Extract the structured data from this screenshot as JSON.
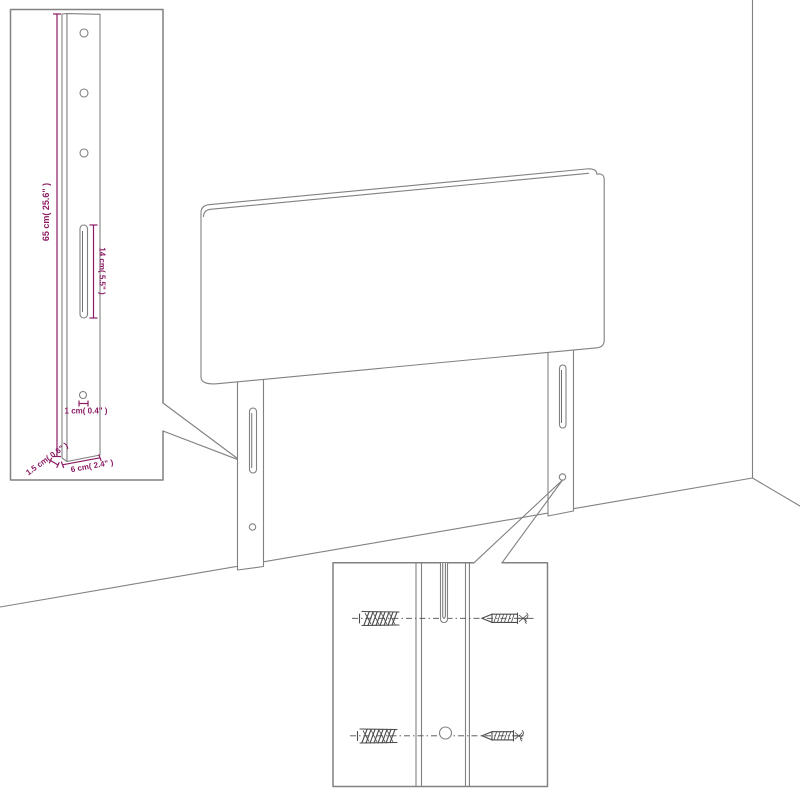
{
  "colors": {
    "line": "#818181",
    "detail": "#4c4c4c",
    "dimension": "#8b1b63",
    "background": "#ffffff"
  },
  "diagram": {
    "type": "product-dimension-diagram",
    "subject": "upholstered headboard with two wall-mount legs shown in a room corner",
    "dimensions": {
      "leg_height": "65 cm( 25.6\" )",
      "slot_length": "14 cm( 5.5\" )",
      "hole_diameter": "1 cm( 0.4\" )",
      "leg_thickness": "1.5 cm( 0.6\" )",
      "leg_width": "6 cm( 2.4\" )"
    },
    "insets": {
      "leg_detail": "enlarged leg with three holes, adjustment slot and screw hole",
      "mounting_detail": "wall plugs and screws aligned with leg slot and hole"
    }
  }
}
